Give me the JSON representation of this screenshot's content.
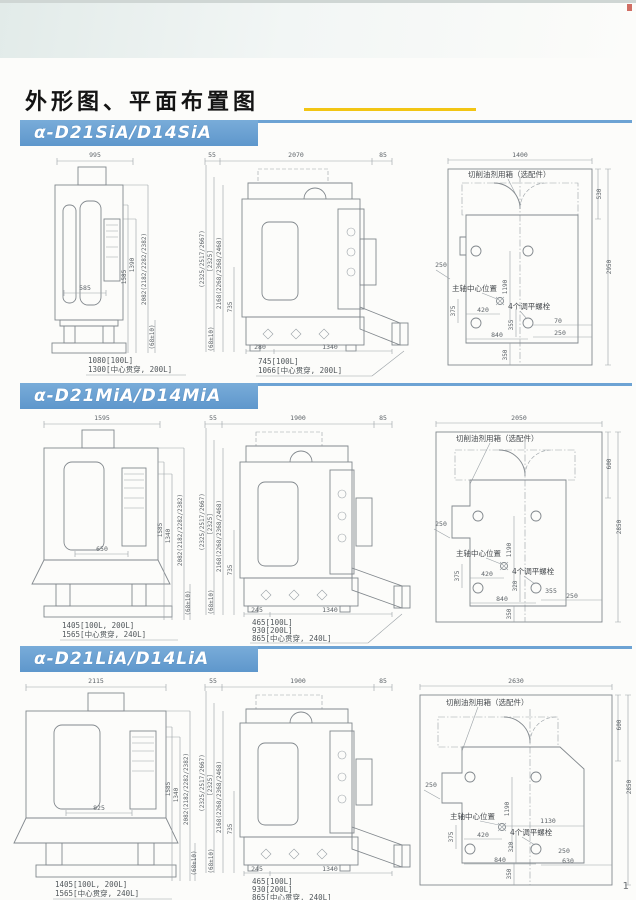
{
  "page": {
    "title": "外形图、平面布置图",
    "page_number": "1"
  },
  "sections": [
    {
      "model": "α-D21SiA/D14SiA",
      "front": {
        "top_width": "995",
        "inner_width": "585",
        "dim_h1": "1585",
        "dim_h2": "1390",
        "dim_total": "2082(2182/2282/2382)",
        "base_tol": "(68±10)",
        "note1": "1080[100L]",
        "note2": "1300[中心贯穿, 200L]"
      },
      "side": {
        "top_d1": "55",
        "top_d2": "2070",
        "top_d3": "85",
        "v1": "(2325/2517/2667)",
        "v2": "[2325]",
        "v3": "2168(2268/2368/2468)",
        "v4": "735",
        "base_tol": "(68±10)",
        "bottom_d1": "280",
        "bottom_d2": "1340",
        "note1": "745[100L]",
        "note2": "1066[中心贯穿, 200L]"
      },
      "plan": {
        "top_width": "1400",
        "tank_label": "切削油剂用箱（选配件）",
        "dim_door": "530",
        "dim_depth": "2950",
        "dim_left": "250",
        "spindle_label": "主轴中心位置",
        "bolt_label": "4个调平螺栓",
        "dim_375": "375",
        "dim_420": "420",
        "dim_mid": "355",
        "dim_840": "840",
        "dim_1190": "1190",
        "dim_r1": "70",
        "dim_r2": "250",
        "dim_350": "350"
      }
    },
    {
      "model": "α-D21MiA/D14MiA",
      "front": {
        "top_width": "1595",
        "inner_width": "650",
        "dim_h1": "1585",
        "dim_h2": "1340",
        "dim_total": "2082(2182/2282/2382)",
        "base_tol": "(68±10)",
        "note1": "1405[100L, 200L]",
        "note2": "1565[中心贯穿, 240L]"
      },
      "side": {
        "top_d1": "55",
        "top_d2": "1900",
        "top_d3": "85",
        "v1": "(2325/2517/2667)",
        "v2": "[2325]",
        "v3": "2168(2268/2368/2468)",
        "v4": "735",
        "base_tol": "(68±10)",
        "bottom_d1": "245",
        "bottom_d2": "1340",
        "note1": "465[100L]",
        "note2": "930[200L]",
        "note3": "865[中心贯穿, 240L]"
      },
      "plan": {
        "top_width": "2050",
        "tank_label": "切削油剂用箱（选配件）",
        "dim_door": "600",
        "dim_depth": "2850",
        "dim_left": "250",
        "spindle_label": "主轴中心位置",
        "bolt_label": "4个调平螺栓",
        "dim_375": "375",
        "dim_420": "420",
        "dim_320": "320",
        "dim_840": "840",
        "dim_1190": "1190",
        "dim_r1": "355",
        "dim_r2": "250",
        "dim_350": "350"
      }
    },
    {
      "model": "α-D21LiA/D14LiA",
      "front": {
        "top_width": "2115",
        "inner_width": "825",
        "dim_h1": "1585",
        "dim_h2": "1340",
        "dim_total": "2082(2182/2282/2382)",
        "base_tol": "(68±10)",
        "note1": "1405[100L, 200L]",
        "note2": "1565[中心贯穿, 240L]"
      },
      "side": {
        "top_d1": "55",
        "top_d2": "1900",
        "top_d3": "85",
        "v1": "(2325/2517/2667)",
        "v2": "[2325]",
        "v3": "2168(2268/2368/2468)",
        "v4": "735",
        "base_tol": "(68±10)",
        "bottom_d1": "245",
        "bottom_d2": "1340",
        "note1": "465[100L]",
        "note2": "930[200L]",
        "note3": "865[中心贯穿, 240L]"
      },
      "plan": {
        "top_width": "2630",
        "tank_label": "切削油剂用箱（选配件）",
        "dim_door": "600",
        "dim_depth": "2850",
        "dim_left": "250",
        "spindle_label": "主轴中心位置",
        "bolt_label": "4个调平螺栓",
        "dim_375": "375",
        "dim_420": "420",
        "dim_320": "320",
        "dim_840": "840",
        "dim_1190": "1190",
        "dim_1130": "1130",
        "dim_r1": "250",
        "dim_r2": "630",
        "dim_350": "350"
      }
    }
  ]
}
